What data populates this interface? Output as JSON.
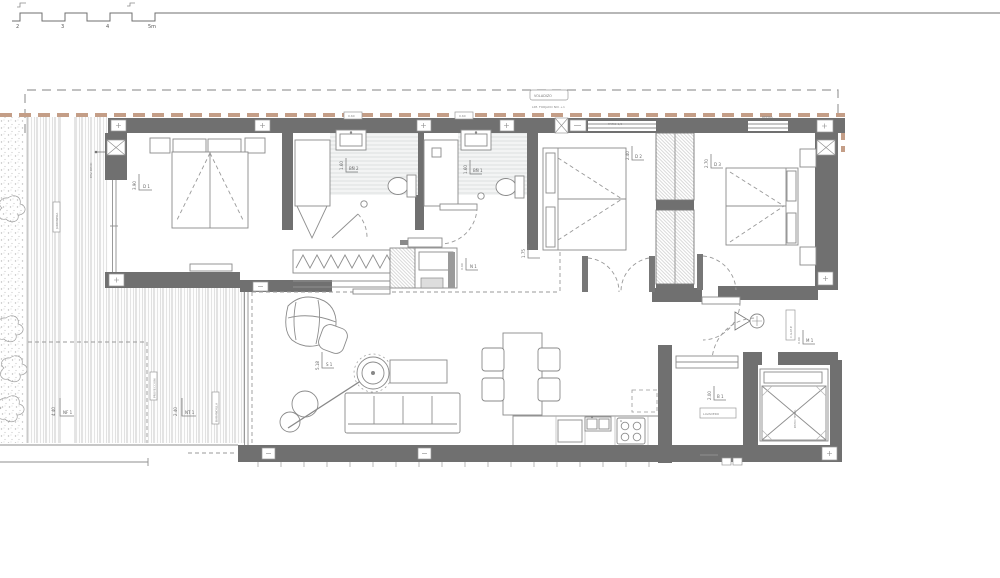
{
  "document": {
    "type": "architectural floor plan",
    "sheet": "apartment floor plan with terrace"
  },
  "scale_bar": {
    "ticks": [
      "2",
      "3",
      "4",
      "5m"
    ]
  },
  "labels": {
    "voladizo": "VOLADIZO",
    "forjado": "LIM. FORJADO NIV. +1",
    "patio13": "PATIO 1/3",
    "repisa": "REPISA",
    "vent1": "0.60",
    "vent2": "0.60",
    "pav_deck": "PAV. DECK",
    "jardinera": "JARDINERA",
    "proyeccion": "PROYECCION",
    "barandilla": "BARANDILLA",
    "lavadero": "LAVADERO",
    "patio_tend": "PATIO TEND.",
    "cuadro": "C.G.M.P."
  },
  "dimensions": {
    "master": {
      "value": "3.90",
      "ref": "D 1"
    },
    "bath1": {
      "value": "1.60",
      "ref": "BÑ 2"
    },
    "bath2": {
      "value": "1.60",
      "ref": "BÑ 1"
    },
    "bed2": {
      "value": "2.40",
      "ref": "D 2"
    },
    "bed3": {
      "value": "2.70",
      "ref": "D 3"
    },
    "living": {
      "value": "5.18",
      "ref": "S 1"
    },
    "hall": {
      "value": "1.75",
      "ref": ""
    },
    "hall2": {
      "value": "0.90",
      "ref": "N 1"
    },
    "terrace1": {
      "value": "4.40",
      "ref": "NF 1"
    },
    "terrace2": {
      "value": "2.40",
      "ref": "NT 1"
    },
    "laundry": {
      "value": "2.00",
      "ref": "B 1"
    },
    "entry": {
      "value": "0.90",
      "ref": "M 1"
    }
  },
  "colors": {
    "wall": "#707070",
    "overhang": "#c49e87",
    "line": "#8a8a8a",
    "hatch": "#cfcfcf"
  }
}
